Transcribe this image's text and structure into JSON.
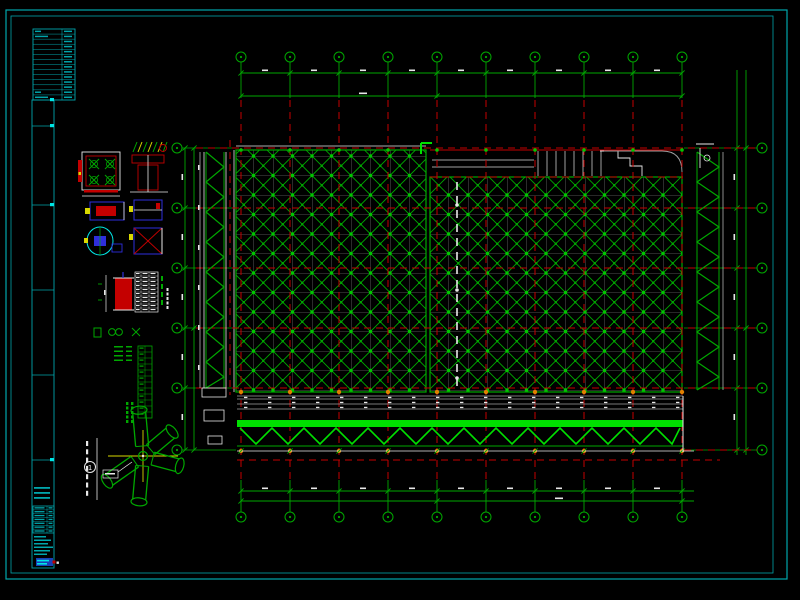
{
  "palette": {
    "background": "#000103",
    "sheet_background": "#000000",
    "border_cyan": "#00A6AC",
    "cyan_bright": "#00E5E5",
    "green": "#00A800",
    "green_bright": "#00E000",
    "green_node": "#00C800",
    "red": "#C40000",
    "grey": "#9F9F9F",
    "white": "#E8E8E8",
    "yellow": "#D8D800",
    "orange": "#E08000",
    "blue": "#2E2EDC",
    "selection_blue": "#1840B8"
  },
  "structural_grid": {
    "top_bubbles": 10,
    "bottom_bubbles": 10,
    "left_bubbles": 6,
    "right_bubbles": 6
  },
  "callouts": {
    "fan_detail_number": "1"
  },
  "title_block": {
    "revision_table_rows": 14,
    "schedule_rows": 7,
    "note_rows": 6
  }
}
